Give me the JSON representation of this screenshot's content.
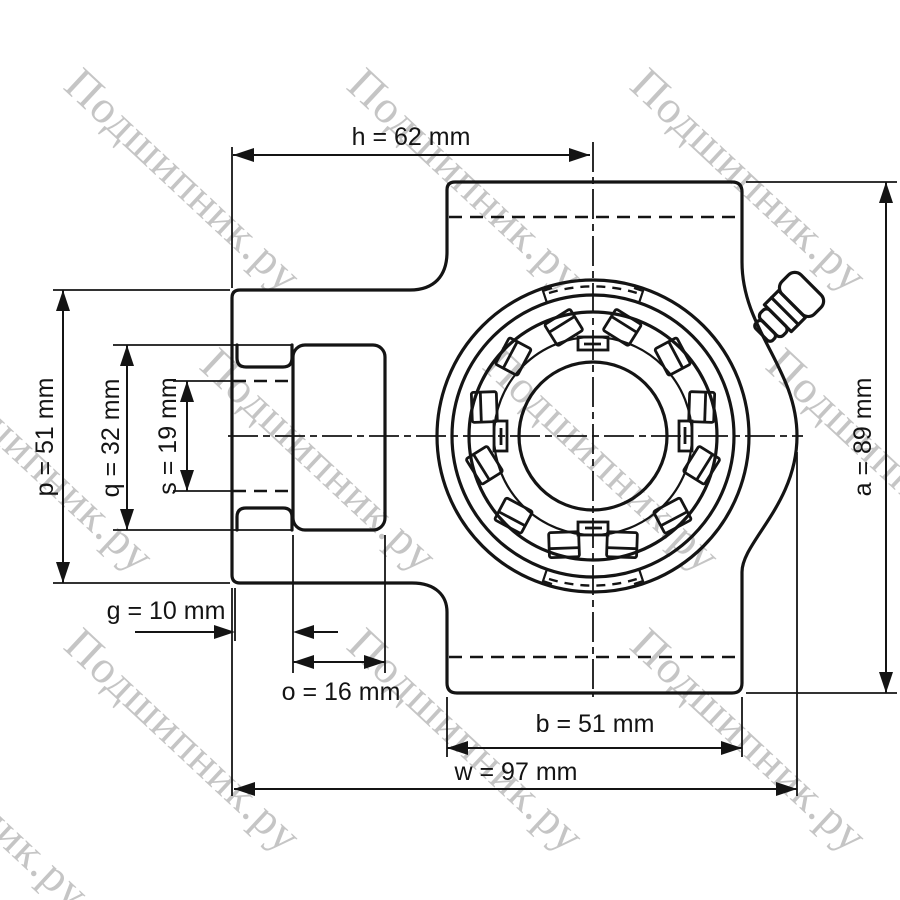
{
  "watermark": {
    "text": "Подшипник.ру",
    "color": "#b6b6b6"
  },
  "colors": {
    "line": "#141414",
    "shaft_fill": "#dcdcdc",
    "background": "#ffffff"
  },
  "drawing": {
    "kind": "take-up bearing unit, side view technical drawing",
    "units": "mm"
  },
  "dimensions": {
    "h": {
      "label": "h = 62 mm",
      "value_mm": 62
    },
    "p": {
      "label": "p = 51 mm",
      "value_mm": 51
    },
    "q": {
      "label": "q = 32 mm",
      "value_mm": 32
    },
    "s": {
      "label": "s = 19 mm",
      "value_mm": 19
    },
    "g": {
      "label": "g = 10 mm",
      "value_mm": 10
    },
    "o": {
      "label": "o = 16 mm",
      "value_mm": 16
    },
    "b": {
      "label": "b = 51 mm",
      "value_mm": 51
    },
    "w": {
      "label": "w = 97 mm",
      "value_mm": 97
    },
    "a": {
      "label": "a = 89 mm",
      "value_mm": 89
    }
  }
}
